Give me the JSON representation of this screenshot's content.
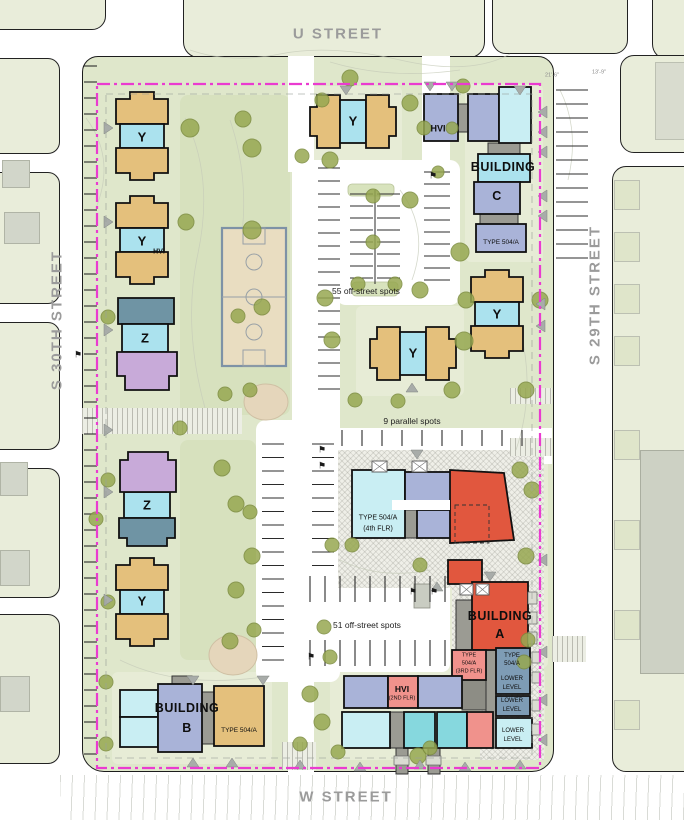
{
  "streets": {
    "top": "U STREET",
    "bottom": "W STREET",
    "left": "S 30TH STREET",
    "right": "S 29TH STREET"
  },
  "parking": {
    "center_lot": "55 off-street spots",
    "south_lot": "51 off-street spots",
    "parallel": "9 parallel spots"
  },
  "units": {
    "y": "Y",
    "z": "Z",
    "hvi": "HVI"
  },
  "buildings": {
    "a1": "BUILDING",
    "a2": "A",
    "b1": "BUILDING",
    "b2": "B",
    "c1": "BUILDING",
    "c2": "C"
  },
  "types": {
    "t504": "TYPE 504/A",
    "t504_4_1": "TYPE 504/A",
    "t504_4_2": "(4th FLR)",
    "t504_3_1": "TYPE",
    "t504_3_2": "504/A",
    "t504_3_3": "(3RD FLR)",
    "t504_s_1": "TYPE",
    "t504_s_2": "504/A",
    "lower": "LOWER",
    "level": "LEVEL",
    "hvi2_1": "HVI",
    "hvi2_2": "(2ND FLR)"
  },
  "dimensions": {
    "d1": "21'-6\"",
    "d2": "13'-9\""
  },
  "colors": {
    "tan": "#e4c07c",
    "cyan": "#abe2ee",
    "cyan_light": "#c9eef3",
    "teal": "#86d8de",
    "periwinkle": "#a9b3d8",
    "slate": "#7e9cb5",
    "slate_green": "#6f94a4",
    "purple": "#c8aad9",
    "pink": "#f0928c",
    "red": "#e1573e",
    "connector_gray": "#9b9b93",
    "dark_gray": "#8d8d85",
    "site_green": "#dfe7cb",
    "context_green": "#e9edda",
    "tree": "#97a851",
    "tree_edge": "#7c8c3e",
    "boundary_magenta": "#ea3bd0",
    "court_tan": "#e9ddc1",
    "court_line": "#98a0a6",
    "street_label": "#9b9b9b"
  }
}
